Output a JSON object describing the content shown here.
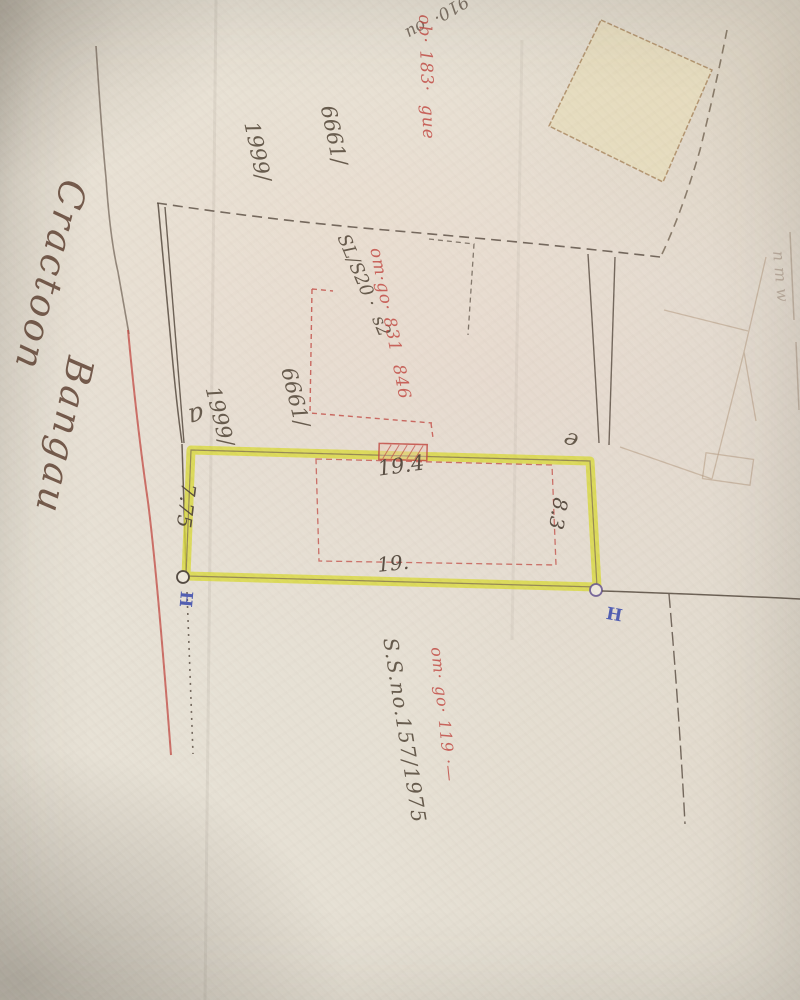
{
  "colors": {
    "paper": "#e5dfd3",
    "ink_dark": "#544839",
    "ink_red": "#c24b44",
    "ink_blue": "#3f4fae",
    "highlight_yellow": "#d8d83a",
    "pencil_faint": "#a8855c"
  },
  "road_label": {
    "word1": "Cractoon",
    "word2": "Bangau"
  },
  "parcel": {
    "corner_label_left": "a",
    "corner_label_right": "e",
    "dim_top": "19.4",
    "dim_right": "8.3",
    "dim_bottom": "19.",
    "dim_left": "7.75"
  },
  "survey_marks": {
    "left": "H",
    "right": "H"
  },
  "notes": {
    "top_tiny": "910·  ou",
    "top_dark_lines": [
      "6661/",
      "1999/"
    ],
    "top_red": "ob· 183·  gue",
    "mid_dark": "SL/S20 ·  s2",
    "mid_red": "om·go· 831  846",
    "mid_dark2_lines": [
      "6661/",
      "1999/"
    ],
    "bottom_dark": "S.S.no.157/1975",
    "bottom_red": "om· go· 119 ·—",
    "right_edge": "nmw"
  }
}
